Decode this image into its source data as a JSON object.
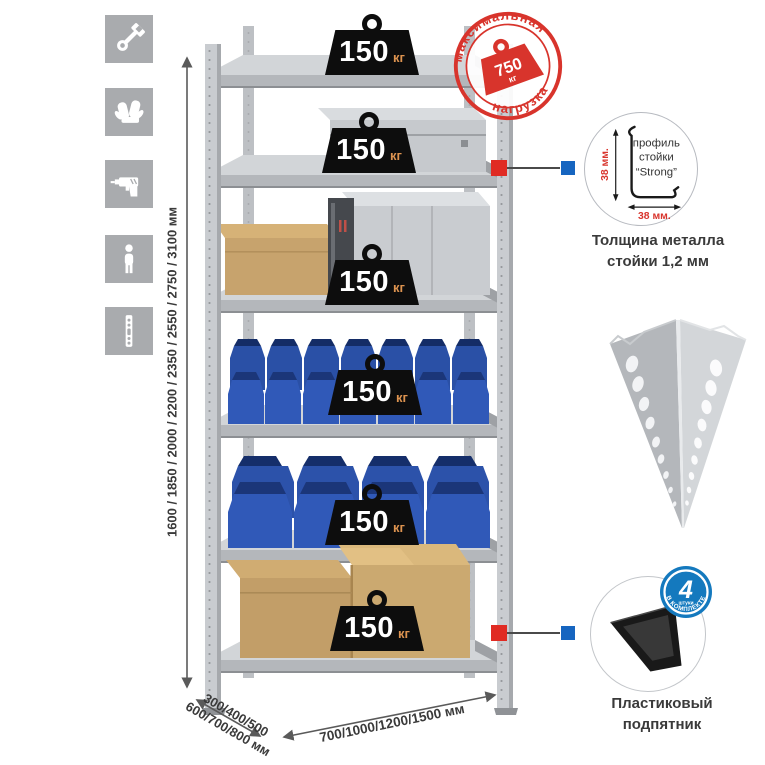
{
  "sidebar": {
    "icons": [
      {
        "name": "wrench"
      },
      {
        "name": "gloves"
      },
      {
        "name": "drill"
      },
      {
        "name": "person"
      },
      {
        "name": "rack-post"
      }
    ]
  },
  "rack": {
    "shelves": [
      {
        "load": "150",
        "unit": "кг"
      },
      {
        "load": "150",
        "unit": "кг"
      },
      {
        "load": "150",
        "unit": "кг"
      },
      {
        "load": "150",
        "unit": "кг"
      },
      {
        "load": "150",
        "unit": "кг"
      },
      {
        "load": "150",
        "unit": "кг"
      }
    ]
  },
  "stamp": {
    "arc_top": "максимальная",
    "arc_bottom": "нагрузка",
    "value": "750",
    "unit": "кг"
  },
  "profile_detail": {
    "label_line1": "профиль",
    "label_line2": "стойки",
    "label_line3": "“Strong”",
    "dim_vertical": "38 мм.",
    "dim_horizontal": "38 мм.",
    "caption_line1": "Толщина металла",
    "caption_line2": "стойки 1,2 мм"
  },
  "foot_detail": {
    "badge_value": "4",
    "badge_sub": "штуки",
    "badge_arc": "в комплекте",
    "caption_line1": "Пластиковый",
    "caption_line2": "подпятник"
  },
  "dimensions": {
    "height": "1600 / 1850 / 2000 / 2200 / 2350 / 2550 / 2750 / 3100 мм",
    "depth_line1": "300/400/500",
    "depth_line2": "600/700/800 мм",
    "width": "700/1000/1200/1500 мм"
  },
  "colors": {
    "accent_red": "#d8342c",
    "accent_blue": "#1673be",
    "bin_blue": "#2f57b2",
    "icon_bg": "#a9abae",
    "weight_black": "#0d0d0d",
    "unit_orange": "#dd9350"
  }
}
